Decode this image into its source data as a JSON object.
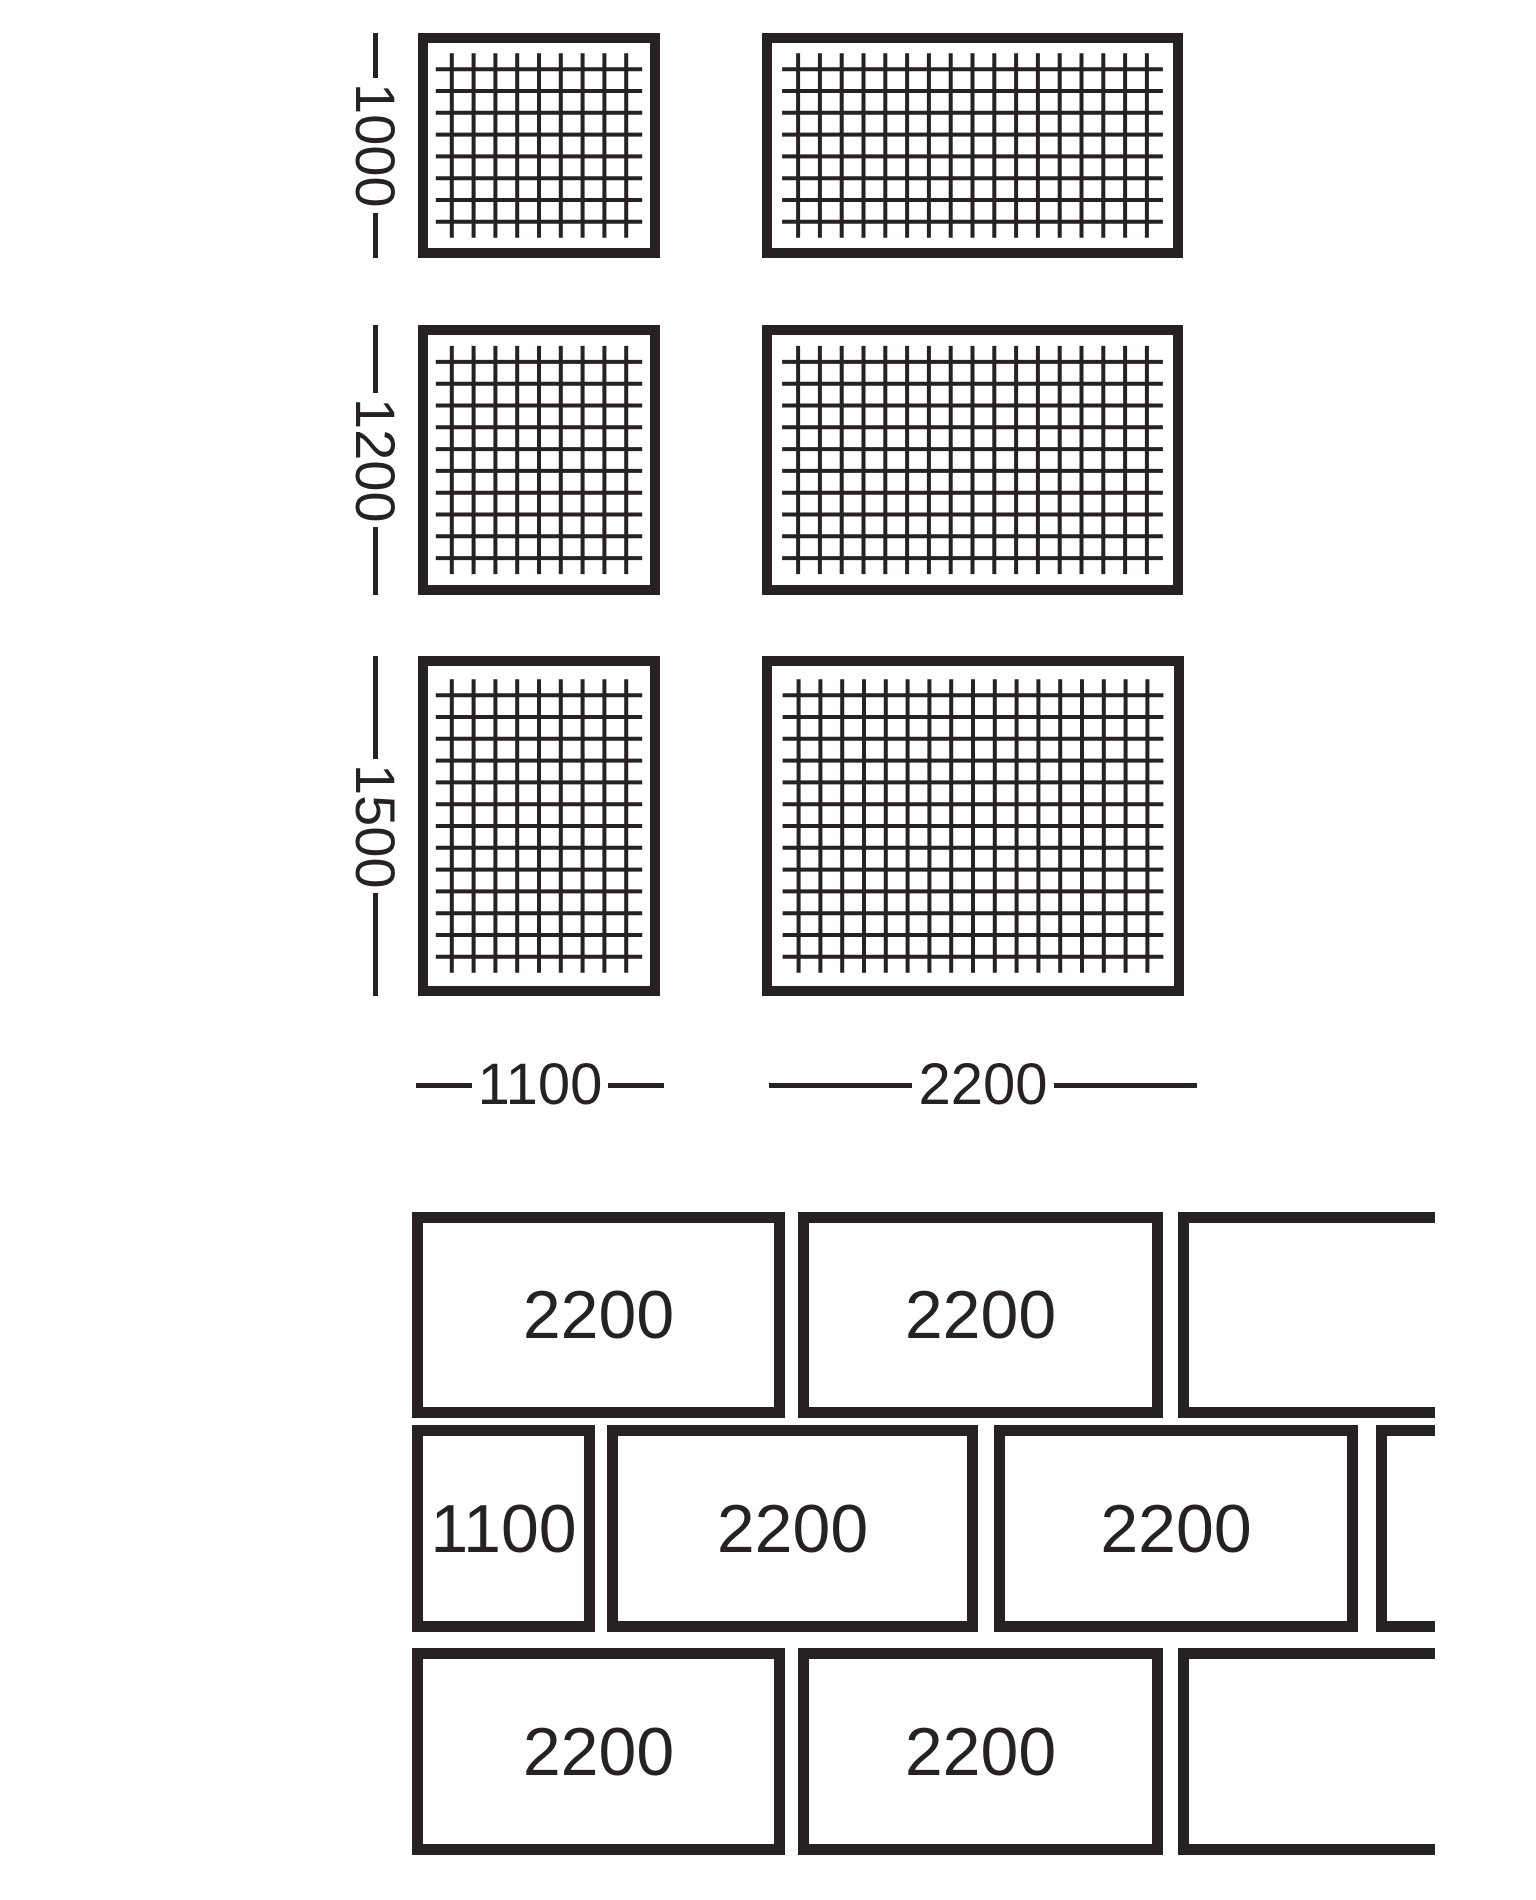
{
  "colors": {
    "ink": "#262223",
    "background": "#ffffff"
  },
  "mesh_chart": {
    "type": "mesh-panel-size-diagram",
    "dim_label_x": 347,
    "dim_label_w": 56,
    "spacing": 21.8,
    "overhang": 16,
    "border": 10,
    "wire": 4,
    "rows": [
      {
        "height_label": "1000",
        "y": 33,
        "h": 225,
        "panels": [
          {
            "x": 418,
            "w": 242,
            "v_wires": 9,
            "h_wires": 8
          },
          {
            "x": 762,
            "w": 421,
            "v_wires": 17,
            "h_wires": 8
          }
        ]
      },
      {
        "height_label": "1200",
        "y": 325,
        "h": 270,
        "panels": [
          {
            "x": 418,
            "w": 242,
            "v_wires": 9,
            "h_wires": 10
          },
          {
            "x": 762,
            "w": 421,
            "v_wires": 17,
            "h_wires": 10
          }
        ]
      },
      {
        "height_label": "1500",
        "y": 656,
        "h": 340,
        "panels": [
          {
            "x": 418,
            "w": 242,
            "v_wires": 9,
            "h_wires": 13
          },
          {
            "x": 762,
            "w": 422,
            "v_wires": 17,
            "h_wires": 13
          }
        ]
      }
    ],
    "width_labels_y": 1048,
    "width_labels_h": 74,
    "width_labels": [
      {
        "label": "1100",
        "x": 416,
        "w": 248
      },
      {
        "label": "2200",
        "x": 769,
        "w": 428
      }
    ]
  },
  "brick_pattern": {
    "type": "running-bond-laying-pattern",
    "rows": [
      {
        "y": 1212,
        "h": 206,
        "bricks": [
          {
            "label": "2200",
            "x": 412,
            "w": 373
          },
          {
            "label": "2200",
            "x": 798,
            "w": 365
          },
          {
            "label": "",
            "x": 1178,
            "w": 257,
            "cut": true
          }
        ]
      },
      {
        "y": 1425,
        "h": 207,
        "bricks": [
          {
            "label": "1100",
            "x": 412,
            "w": 183
          },
          {
            "label": "2200",
            "x": 607,
            "w": 371
          },
          {
            "label": "2200",
            "x": 994,
            "w": 364
          },
          {
            "label": "",
            "x": 1376,
            "w": 59,
            "cut": true
          }
        ]
      },
      {
        "y": 1648,
        "h": 207,
        "bricks": [
          {
            "label": "2200",
            "x": 412,
            "w": 373
          },
          {
            "label": "2200",
            "x": 798,
            "w": 365
          },
          {
            "label": "",
            "x": 1178,
            "w": 257,
            "cut": true
          }
        ]
      }
    ]
  }
}
